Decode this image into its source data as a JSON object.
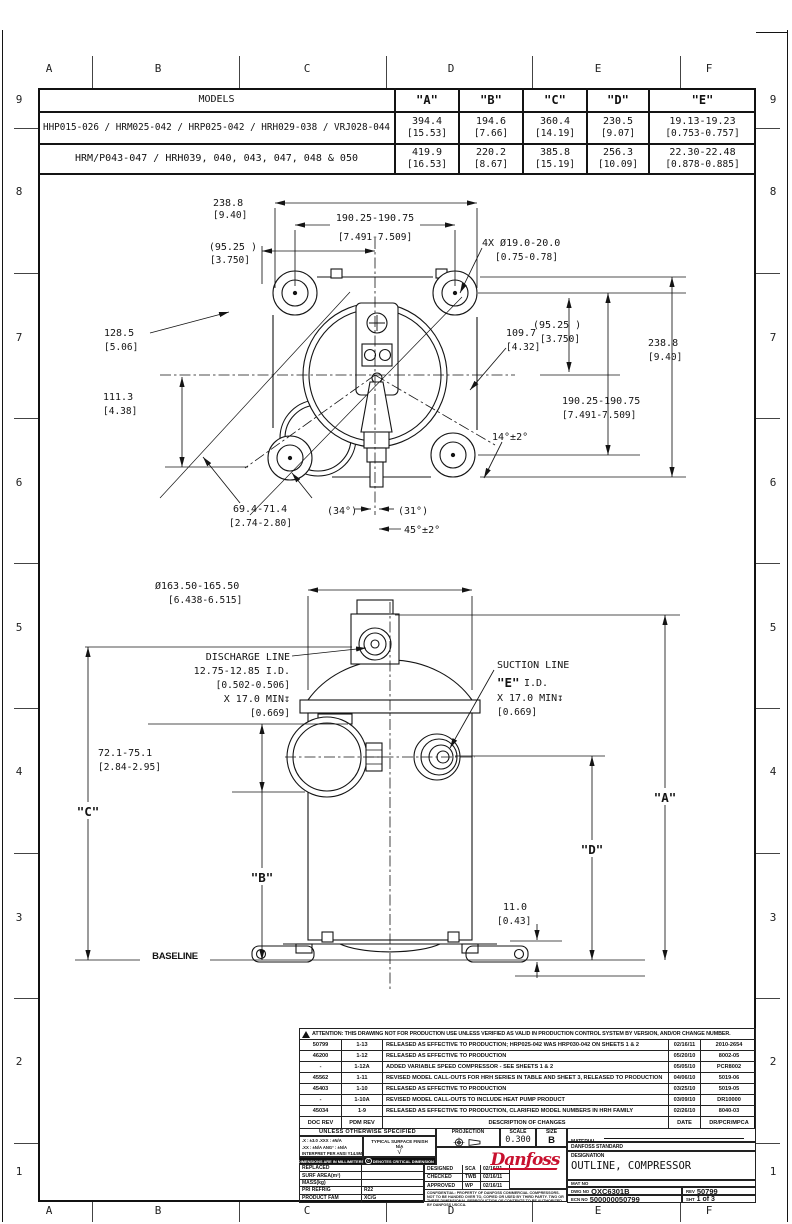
{
  "sheet": {
    "zone_letters": [
      "A",
      "B",
      "C",
      "D",
      "E",
      "F"
    ],
    "zone_numbers": [
      "9",
      "8",
      "7",
      "6",
      "5",
      "4",
      "3",
      "2",
      "1"
    ]
  },
  "models_table": {
    "title": "MODELS",
    "col_a": "\"A\"",
    "col_b": "\"B\"",
    "col_c": "\"C\"",
    "col_d": "\"D\"",
    "col_e": "\"E\"",
    "rows": [
      {
        "models": "HHP015-026 / HRM025-042 / HRP025-042 / HRH029-038 / VRJ028-044",
        "a_mm": "394.4",
        "a_in": "[15.53]",
        "b_mm": "194.6",
        "b_in": "[7.66]",
        "c_mm": "360.4",
        "c_in": "[14.19]",
        "d_mm": "230.5",
        "d_in": "[9.07]",
        "e_mm": "19.13-19.23",
        "e_in": "[0.753-0.757]"
      },
      {
        "models": "HRM/P043-047 / HRH039, 040, 043, 047, 048 & 050",
        "a_mm": "419.9",
        "a_in": "[16.53]",
        "b_mm": "220.2",
        "b_in": "[8.67]",
        "c_mm": "385.8",
        "c_in": "[15.19]",
        "d_mm": "256.3",
        "d_in": "[10.09]",
        "e_mm": "22.30-22.48",
        "e_in": "[0.878-0.885]"
      }
    ]
  },
  "top_view": {
    "w_mm": "238.8",
    "w_in": "[9.40]",
    "span_mm": "190.25-190.75",
    "span_in": "[7.491-7.509]",
    "half_mm": "(95.25  )",
    "half_in": "[3.750]",
    "holes_1": "4X Ø19.0-20.0",
    "holes_2": "[0.75-0.78]",
    "d128_mm": "128.5",
    "d128_in": "[5.06]",
    "d109_mm": "109.7",
    "d109_in": "[4.32]",
    "d111_mm": "111.3",
    "d111_in": "[4.38]",
    "a14": "14°±2°",
    "d69_mm": "69.4-71.4",
    "d69_in": "[2.74-2.80]",
    "a34": "(34°)",
    "a31": "(31°)",
    "a45": "45°±2°"
  },
  "side_view": {
    "dia_mm": "Ø163.50-165.50",
    "dia_in": "[6.438-6.515]",
    "discharge_1": "DISCHARGE LINE",
    "discharge_2": "12.75-12.85 I.D.",
    "discharge_3": "[0.502-0.506]",
    "discharge_4": "X 17.0 MIN↧",
    "discharge_5": "[0.669]",
    "suction_1": "SUCTION LINE",
    "suction_e": "\"E\"",
    "suction_id": "I.D.",
    "suction_3": "X 17.0 MIN↧",
    "suction_4": "[0.669]",
    "d72_mm": "72.1-75.1",
    "d72_in": "[2.84-2.95]",
    "a": "\"A\"",
    "b": "\"B\"",
    "c": "\"C\"",
    "d": "\"D\"",
    "baseline": "BASELINE",
    "d11_mm": "11.0",
    "d11_in": "[0.43]"
  },
  "title_block": {
    "attention": "ATTENTION: THIS DRAWING NOT FOR PRODUCTION USE UNLESS VERIFIED AS VALID IN PRODUCTION CONTROL SYSTEM BY VERSION, AND/OR CHANGE NUMBER.",
    "revisions": [
      {
        "doc": "50799",
        "pdm": "1-13",
        "desc": "RELEASED AS EFFECTIVE TO PRODUCTION; HRP025-042 WAS HRP030-042 ON SHEETS 1 & 2",
        "date": "02/16/11",
        "ref": "2010-2654"
      },
      {
        "doc": "46200",
        "pdm": "1-12",
        "desc": "RELEASED AS EFFECTIVE TO PRODUCTION",
        "date": "05/20/10",
        "ref": "8002-05"
      },
      {
        "doc": "-",
        "pdm": "1-12A",
        "desc": "ADDED VARIABLE SPEED COMPRESSOR - SEE SHEETS 1 & 2",
        "date": "05/05/10",
        "ref": "PCR8002"
      },
      {
        "doc": "45562",
        "pdm": "1-11",
        "desc": "REVISED MODEL CALL-OUTS FOR HRH SERIES IN TABLE AND SHEET 3, RELEASED TO PRODUCTION",
        "date": "04/06/10",
        "ref": "5019-06"
      },
      {
        "doc": "45403",
        "pdm": "1-10",
        "desc": "RELEASED AS EFFECTIVE TO PRODUCTION",
        "date": "03/25/10",
        "ref": "5019-05"
      },
      {
        "doc": "-",
        "pdm": "1-10A",
        "desc": "REVISED MODEL CALL-OUTS TO INCLUDE HEAT PUMP PRODUCT",
        "date": "03/09/10",
        "ref": "DR10000"
      },
      {
        "doc": "45034",
        "pdm": "1-9",
        "desc": "RELEASED AS EFFECTIVE TO PRODUCTION, CLARIFIED MODEL NUMBERS IN HRH FAMILY",
        "date": "02/26/10",
        "ref": "8040-03"
      }
    ],
    "rev_header": {
      "doc": "DOC REV",
      "pdm": "PDM REV",
      "desc": "DESCRIPTION OF CHANGES",
      "date": "DATE",
      "ref": "DR/PCR/MPCA"
    },
    "spec": {
      "unless": "UNLESS OTHERWISE SPECIFIED",
      "tol1": ".X : ±3.0   .XXX : ±N/A",
      "tol2": ".XX : ±N/A   ANG° : ±N/A",
      "interpret": "INTERPRET PER ANSI Y14.5M-1994",
      "surface": "TYPICAL SURFACE FINISH",
      "surface_val": "N/A",
      "dims_units": "DIMENSIONS ARE IN MILLIMETERS",
      "critical": "DENOTES CRITICAL DIMENSION"
    },
    "left_rows": [
      {
        "label": "REPLACED",
        "value": ""
      },
      {
        "label": "SURF AREA(m²)",
        "value": ""
      },
      {
        "label": "MASS(kg)",
        "value": ""
      },
      {
        "label": "PRI REFRIG",
        "value": "R22"
      },
      {
        "label": "PRODUCT FAM",
        "value": "XC/G"
      }
    ],
    "approvals": [
      {
        "label": "DESIGNED",
        "who": "SCA",
        "date": "02/16/11"
      },
      {
        "label": "CHECKED",
        "who": "TWB",
        "date": "02/16/11"
      },
      {
        "label": "APPROVED",
        "who": "WP",
        "date": "02/16/11"
      }
    ],
    "confidential": "CONFIDENTIAL: PROPERTY OF DANFOSS COMMERCIAL COMPRESSORS. NOT TO BE HANDED OVER TO, COPIED OR USED BY THIRD PARTY. TWO OR THREE DIMENSIONAL REPRODUCTION OF CONTENTS TO BE AUTHORIZED BY DANFOSS USCCA.",
    "projection_label": "PROJECTION",
    "scale_label": "SCALE",
    "scale_value": "0.300",
    "size_label": "SIZE",
    "size_value": "B",
    "material_label": "MATERIAL",
    "material_value": "DANFOSS STANDARD",
    "designation_label": "DESIGNATION",
    "designation_value": "OUTLINE, COMPRESSOR",
    "mat_no_label": "MAT NO",
    "dwg_no_label": "DWG NO",
    "dwg_no": "OXC6301B",
    "rev_label": "REV",
    "rev": "50799",
    "ecn_label": "ECN NO",
    "ecn": "500000050799",
    "sht_label": "SHT",
    "sht_value": "1 of 3",
    "logo": "Danfoss",
    "brand_red": "#c8102e"
  }
}
